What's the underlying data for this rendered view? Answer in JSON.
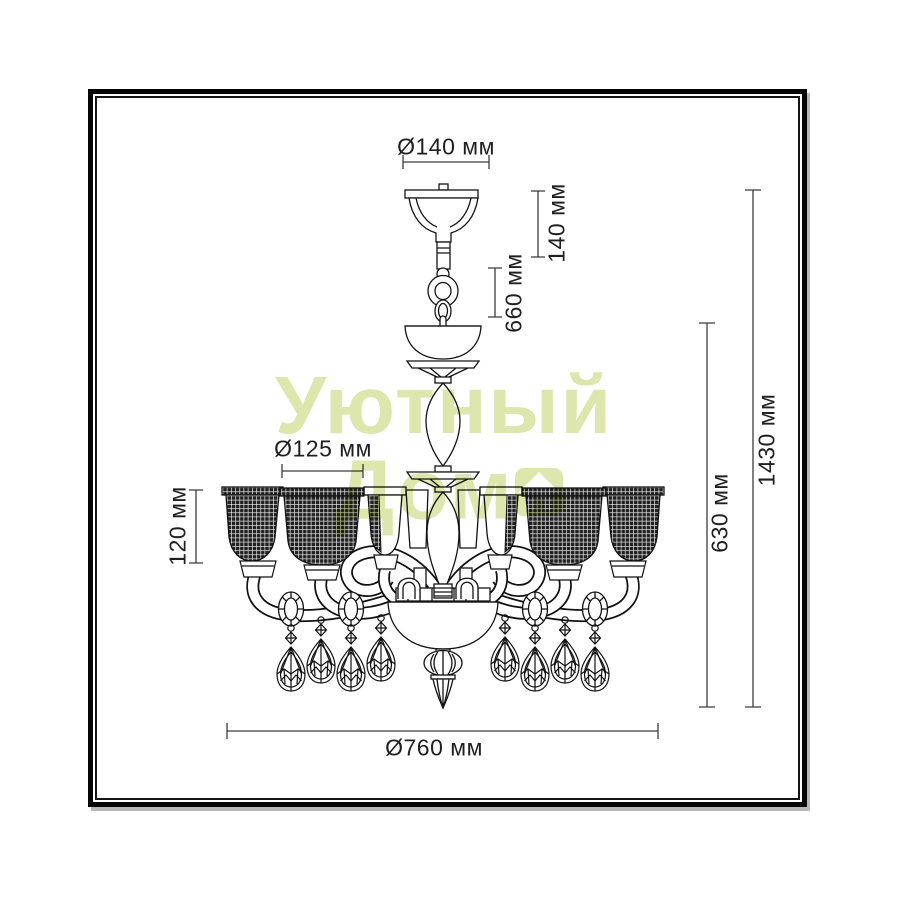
{
  "diagram": {
    "subject": "chandelier dimension drawing",
    "dimensions": {
      "canopy_diameter": "Ø140 мм",
      "canopy_height": "140 мм",
      "chain_section_height": "660 мм",
      "shade_diameter": "Ø125 мм",
      "shade_height": "120 мм",
      "body_height": "630 мм",
      "total_height": "1430 мм",
      "total_diameter": "Ø760 мм"
    }
  },
  "watermark": {
    "line1": "Уютный",
    "line2": "Дом",
    "color": "#d9e4a4"
  }
}
